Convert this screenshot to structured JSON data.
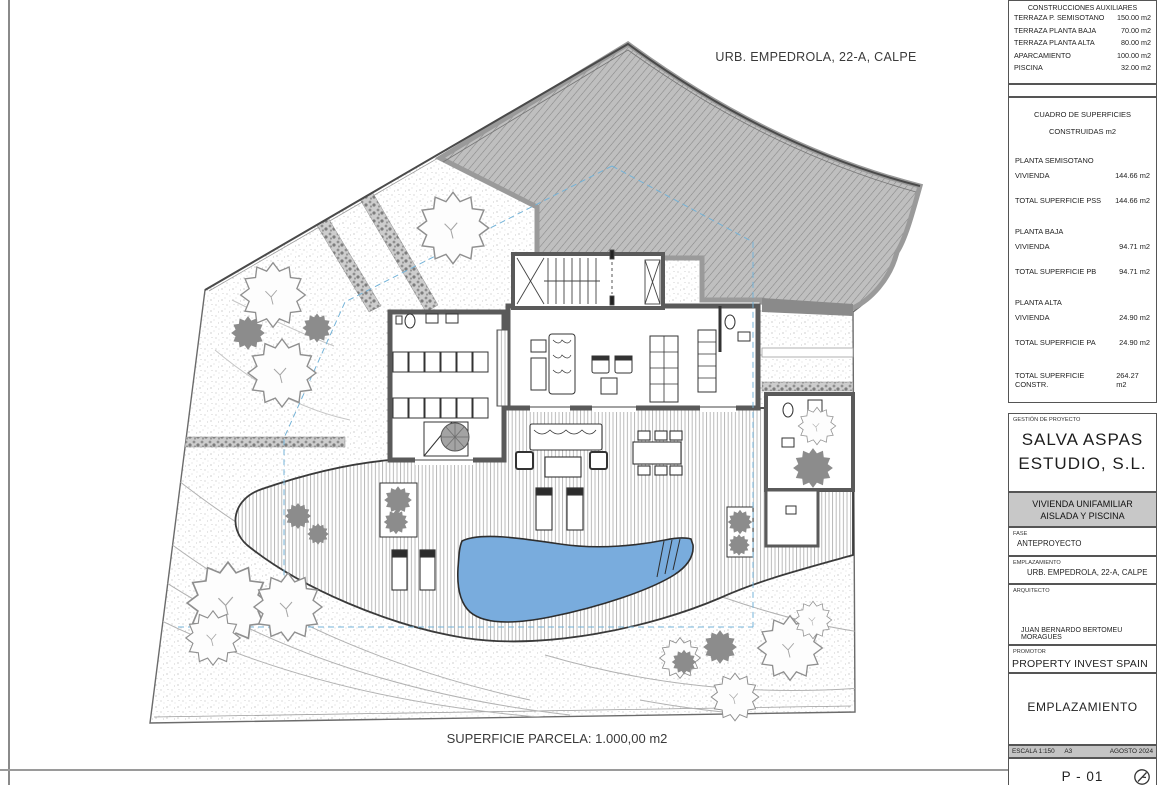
{
  "drawing": {
    "site_label": "URB. EMPEDROLA, 22-A, CALPE",
    "parcel_caption": "SUPERFICIE PARCELA: 1.000,00 m2"
  },
  "colors": {
    "pool": "#79ACDD",
    "slope_hatch": "#bfbfbf",
    "band_gray": "#c8c8c8"
  },
  "titleblock": {
    "aux_table": {
      "title": "CONSTRUCCIONES AUXILIARES",
      "rows": [
        {
          "label": "TERRAZA P. SEMISOTANO",
          "value": "150.00 m2"
        },
        {
          "label": "TERRAZA PLANTA BAJA",
          "value": "70.00 m2"
        },
        {
          "label": "TERRAZA PLANTA ALTA",
          "value": "80.00 m2"
        },
        {
          "label": "APARCAMIENTO",
          "value": "100.00 m2"
        },
        {
          "label": "PISCINA",
          "value": "32.00 m2"
        }
      ]
    },
    "surfaces": {
      "title_line1": "CUADRO DE SUPERFICIES",
      "title_line2": "CONSTRUIDAS m2",
      "s1_heading": "PLANTA SEMISOTANO",
      "s1_row_label": "VIVIENDA",
      "s1_row_value": "144.66 m2",
      "s1_total_label": "TOTAL SUPERFICIE PSS",
      "s1_total_value": "144.66 m2",
      "s2_heading": "PLANTA BAJA",
      "s2_row_label": "VIVIENDA",
      "s2_row_value": "94.71 m2",
      "s2_total_label": "TOTAL SUPERFICIE PB",
      "s2_total_value": "94.71 m2",
      "s3_heading": "PLANTA ALTA",
      "s3_row_label": "VIVIENDA",
      "s3_row_value": "24.90 m2",
      "s3_total_label": "TOTAL SUPERFICIE PA",
      "s3_total_value": "24.90 m2",
      "grand_label": "TOTAL SUPERFICIE CONSTR.",
      "grand_value": "264.27 m2"
    },
    "management": {
      "label": "GESTIÓN DE PROYECTO",
      "name_line1": "SALVA ASPAS",
      "name_line2": "ESTUDIO, S.L."
    },
    "project": {
      "line1": "VIVIENDA UNIFAMILIAR",
      "line2": "AISLADA Y PISCINA"
    },
    "fase_label": "FASE",
    "fase_value": "ANTEPROYECTO",
    "empl_label": "EMPLAZAMIENTO",
    "empl_value": "URB. EMPEDROLA, 22-A, CALPE",
    "arq_label": "ARQUITECTO",
    "arq_value": "JUAN BERNARDO BERTOMEU MORAGUES",
    "prom_label": "PROMOTOR",
    "prom_value": "PROPERTY INVEST SPAIN S.L.",
    "sheet": {
      "title": "EMPLAZAMIENTO",
      "scale": "ESCALA 1:150",
      "paper": "A3",
      "date": "AGOSTO 2024",
      "number": "P - 01"
    }
  }
}
